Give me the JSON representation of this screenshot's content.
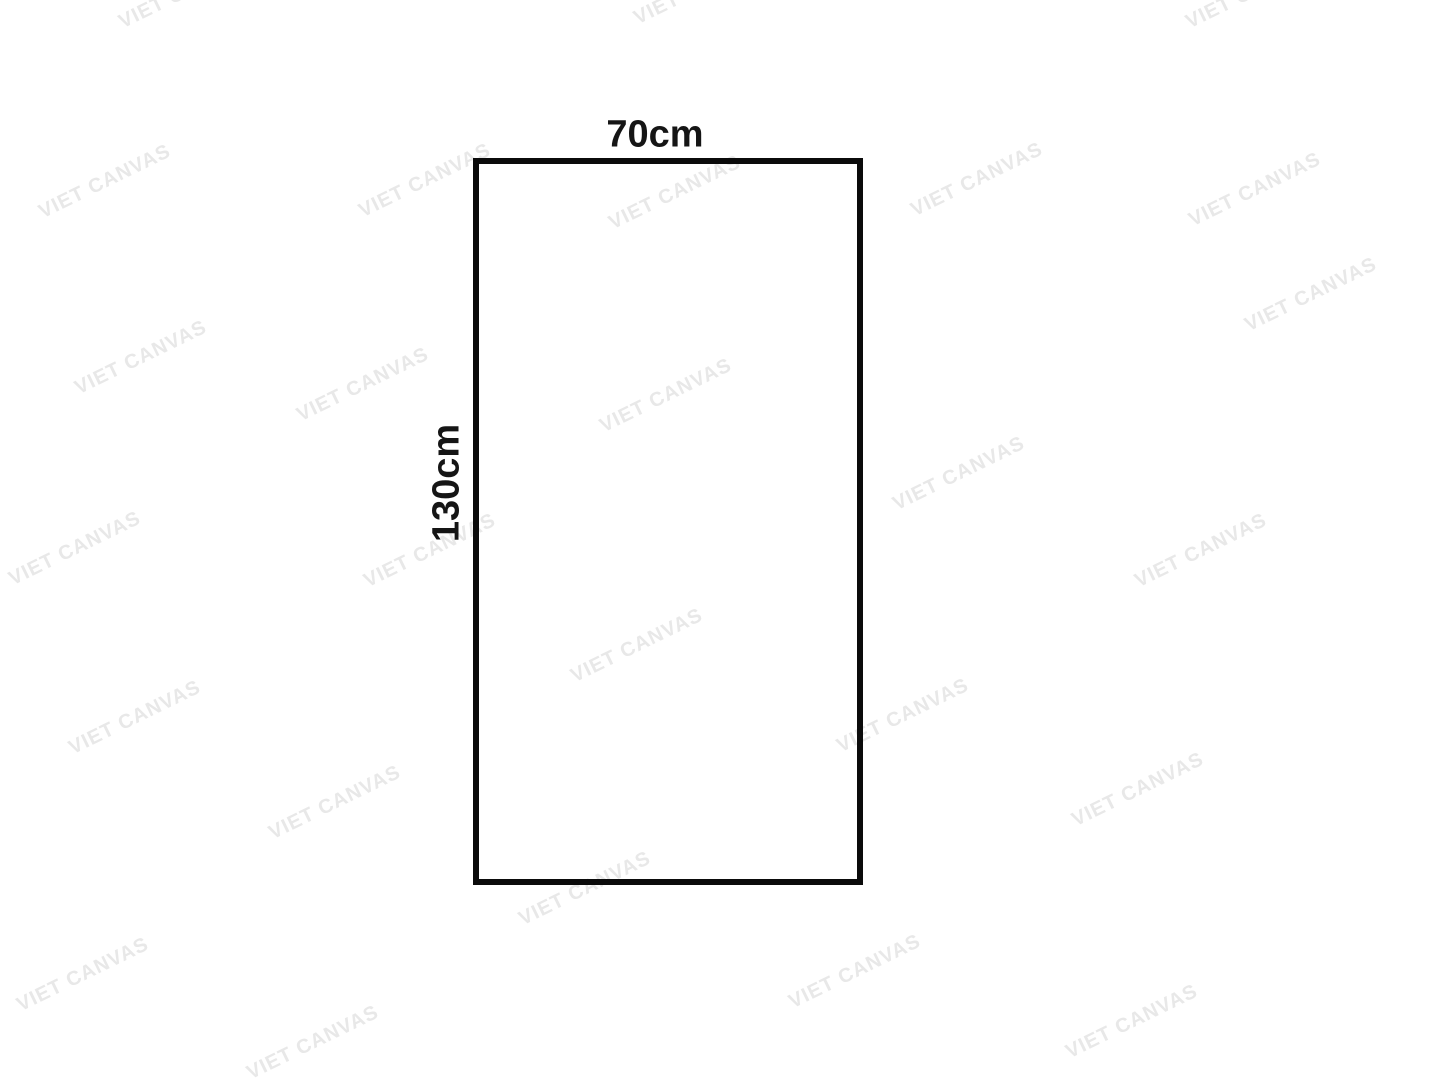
{
  "diagram": {
    "width_label": "70cm",
    "height_label": "130cm"
  },
  "watermark": {
    "text": "VIET CANVAS",
    "color": "#e8e8e8",
    "angle_deg": -26,
    "positions": [
      {
        "x": 185,
        "y": -8
      },
      {
        "x": 700,
        "y": -12
      },
      {
        "x": 1252,
        "y": -8
      },
      {
        "x": 105,
        "y": 182
      },
      {
        "x": 425,
        "y": 181
      },
      {
        "x": 675,
        "y": 193
      },
      {
        "x": 977,
        "y": 180
      },
      {
        "x": 1255,
        "y": 190
      },
      {
        "x": 1311,
        "y": 295
      },
      {
        "x": 141,
        "y": 358
      },
      {
        "x": 363,
        "y": 385
      },
      {
        "x": 666,
        "y": 396
      },
      {
        "x": 959,
        "y": 474
      },
      {
        "x": 75,
        "y": 549
      },
      {
        "x": 430,
        "y": 551
      },
      {
        "x": 1201,
        "y": 551
      },
      {
        "x": 637,
        "y": 646
      },
      {
        "x": 135,
        "y": 718
      },
      {
        "x": 903,
        "y": 716
      },
      {
        "x": 335,
        "y": 803
      },
      {
        "x": 1138,
        "y": 790
      },
      {
        "x": 585,
        "y": 889
      },
      {
        "x": 83,
        "y": 975
      },
      {
        "x": 855,
        "y": 972
      },
      {
        "x": 313,
        "y": 1043
      },
      {
        "x": 1132,
        "y": 1022
      }
    ]
  },
  "colors": {
    "background": "#ffffff",
    "outline": "#0b0b0b",
    "label_text": "#151515"
  }
}
